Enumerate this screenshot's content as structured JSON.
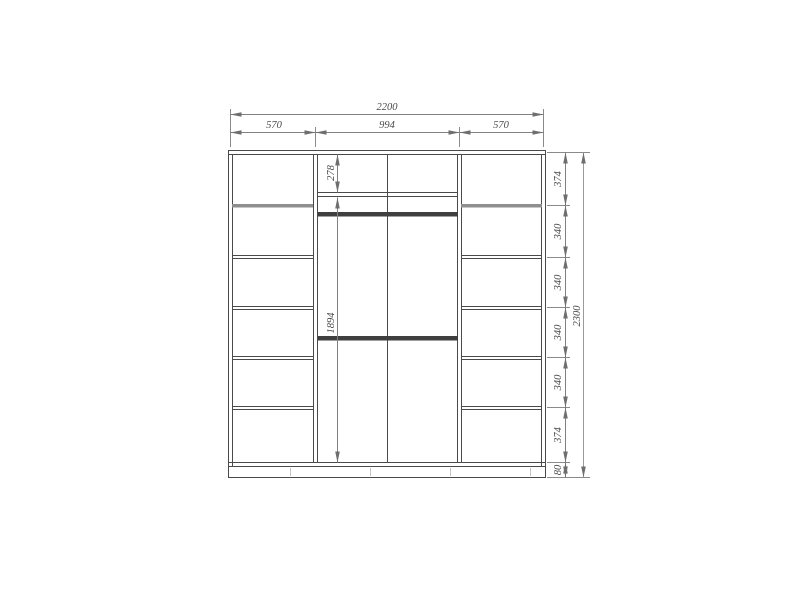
{
  "drawing": {
    "kind": "wardrobe-front-elevation-dimension-drawing",
    "colors": {
      "background": "#ffffff",
      "carcass_line": "#4a4a4a",
      "dimension_line": "#808080",
      "label_text": "#4a4a4a",
      "hanging_rail": "#3f3f3f",
      "thick_shelf": "#8f8f8f"
    },
    "dims": {
      "overall_width": "2200",
      "section_widths": [
        "570",
        "994",
        "570"
      ],
      "right_heights": [
        "374",
        "340",
        "340",
        "340",
        "340",
        "374",
        "80"
      ],
      "overall_height": "2300",
      "top_shelf_height": "278",
      "main_height": "1894"
    }
  }
}
